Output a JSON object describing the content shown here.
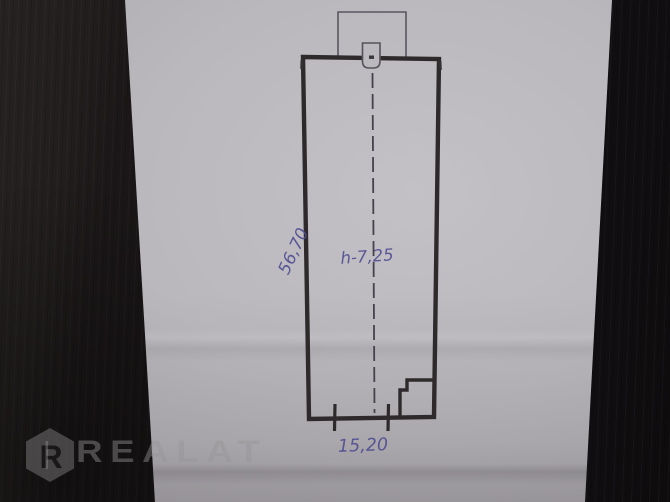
{
  "photo": {
    "description_label": "hand-drawn floor plan sketch on paper",
    "plan": {
      "dimensions": {
        "left_vertical": "56,70",
        "ceiling_height": "h-7,25",
        "bottom_width": "15,20"
      },
      "pen_line_color": "#2e2a2c",
      "handwriting_ink_color": "#514f93"
    },
    "watermark": {
      "logo_letter": "R",
      "brand_text": "REALAT"
    },
    "colors": {
      "paper": "#bab8bc",
      "wood_left": "#232020",
      "wood_right": "#121013"
    }
  }
}
